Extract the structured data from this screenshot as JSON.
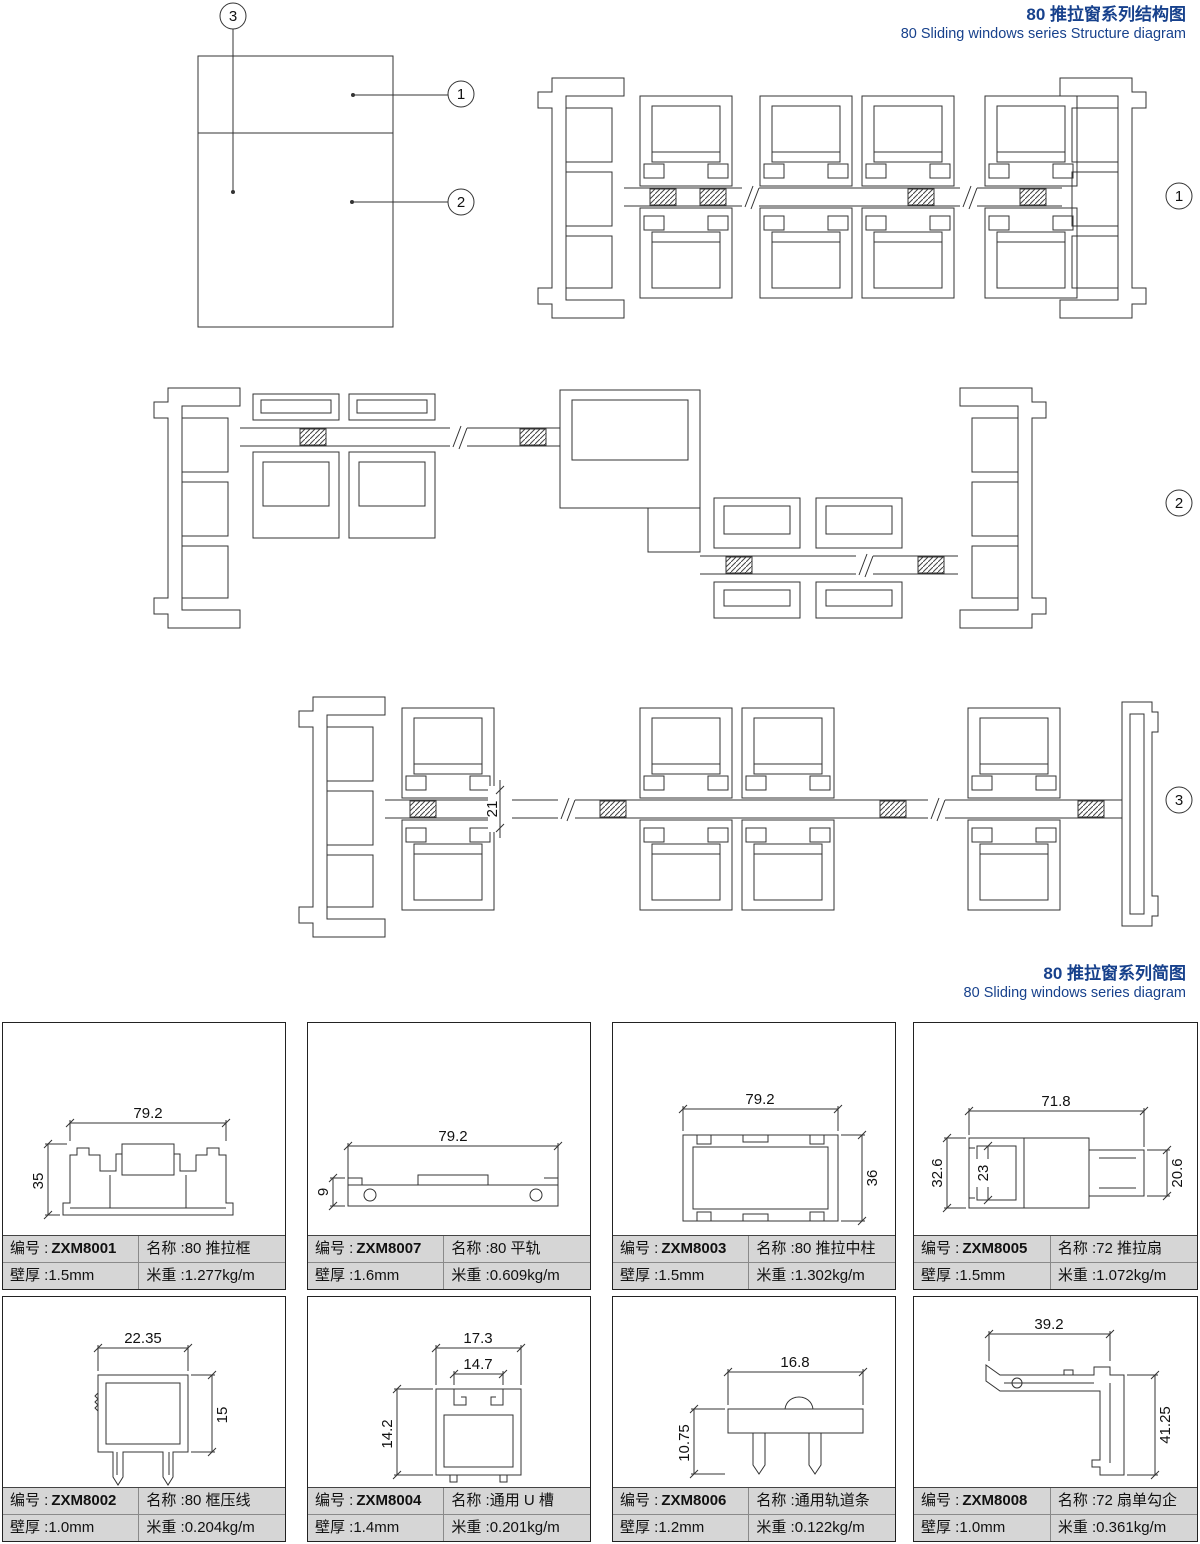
{
  "colors": {
    "accent": "#17418c",
    "line": "#333333",
    "table_bg": "#d6d6d6"
  },
  "titles": {
    "structure_cn": "80 推拉窗系列结构图",
    "structure_en": "80 Sliding windows series Structure diagram",
    "diagram_cn": "80 推拉窗系列简图",
    "diagram_en": "80 Sliding windows series diagram"
  },
  "callouts": {
    "c1": "1",
    "c2": "2",
    "c3": "3"
  },
  "structure": {
    "glass_dim": "21"
  },
  "labels": {
    "code": "编号 :",
    "name": "名称 :",
    "wall": "壁厚 :",
    "weight": "米重 :"
  },
  "cards": [
    {
      "code": "ZXM8001",
      "name": "80 推拉框",
      "wall": "1.5mm",
      "weight": "1.277kg/m",
      "dims": [
        "79.2",
        "35"
      ]
    },
    {
      "code": "ZXM8007",
      "name": "80 平轨",
      "wall": "1.6mm",
      "weight": "0.609kg/m",
      "dims": [
        "79.2",
        "9"
      ]
    },
    {
      "code": "ZXM8003",
      "name": "80 推拉中柱",
      "wall": "1.5mm",
      "weight": "1.302kg/m",
      "dims": [
        "79.2",
        "36"
      ]
    },
    {
      "code": "ZXM8005",
      "name": "72 推拉扇",
      "wall": "1.5mm",
      "weight": "1.072kg/m",
      "dims": [
        "71.8",
        "32.6",
        "23",
        "20.6"
      ]
    },
    {
      "code": "ZXM8002",
      "name": "80 框压线",
      "wall": "1.0mm",
      "weight": "0.204kg/m",
      "dims": [
        "22.35",
        "15"
      ]
    },
    {
      "code": "ZXM8004",
      "name": "通用 U 槽",
      "wall": "1.4mm",
      "weight": "0.201kg/m",
      "dims": [
        "17.3",
        "14.7",
        "14.2"
      ]
    },
    {
      "code": "ZXM8006",
      "name": "通用轨道条",
      "wall": "1.2mm",
      "weight": "0.122kg/m",
      "dims": [
        "16.8",
        "10.75"
      ]
    },
    {
      "code": "ZXM8008",
      "name": "72 扇单勾企",
      "wall": "1.0mm",
      "weight": "0.361kg/m",
      "dims": [
        "39.2",
        "41.25"
      ]
    }
  ]
}
